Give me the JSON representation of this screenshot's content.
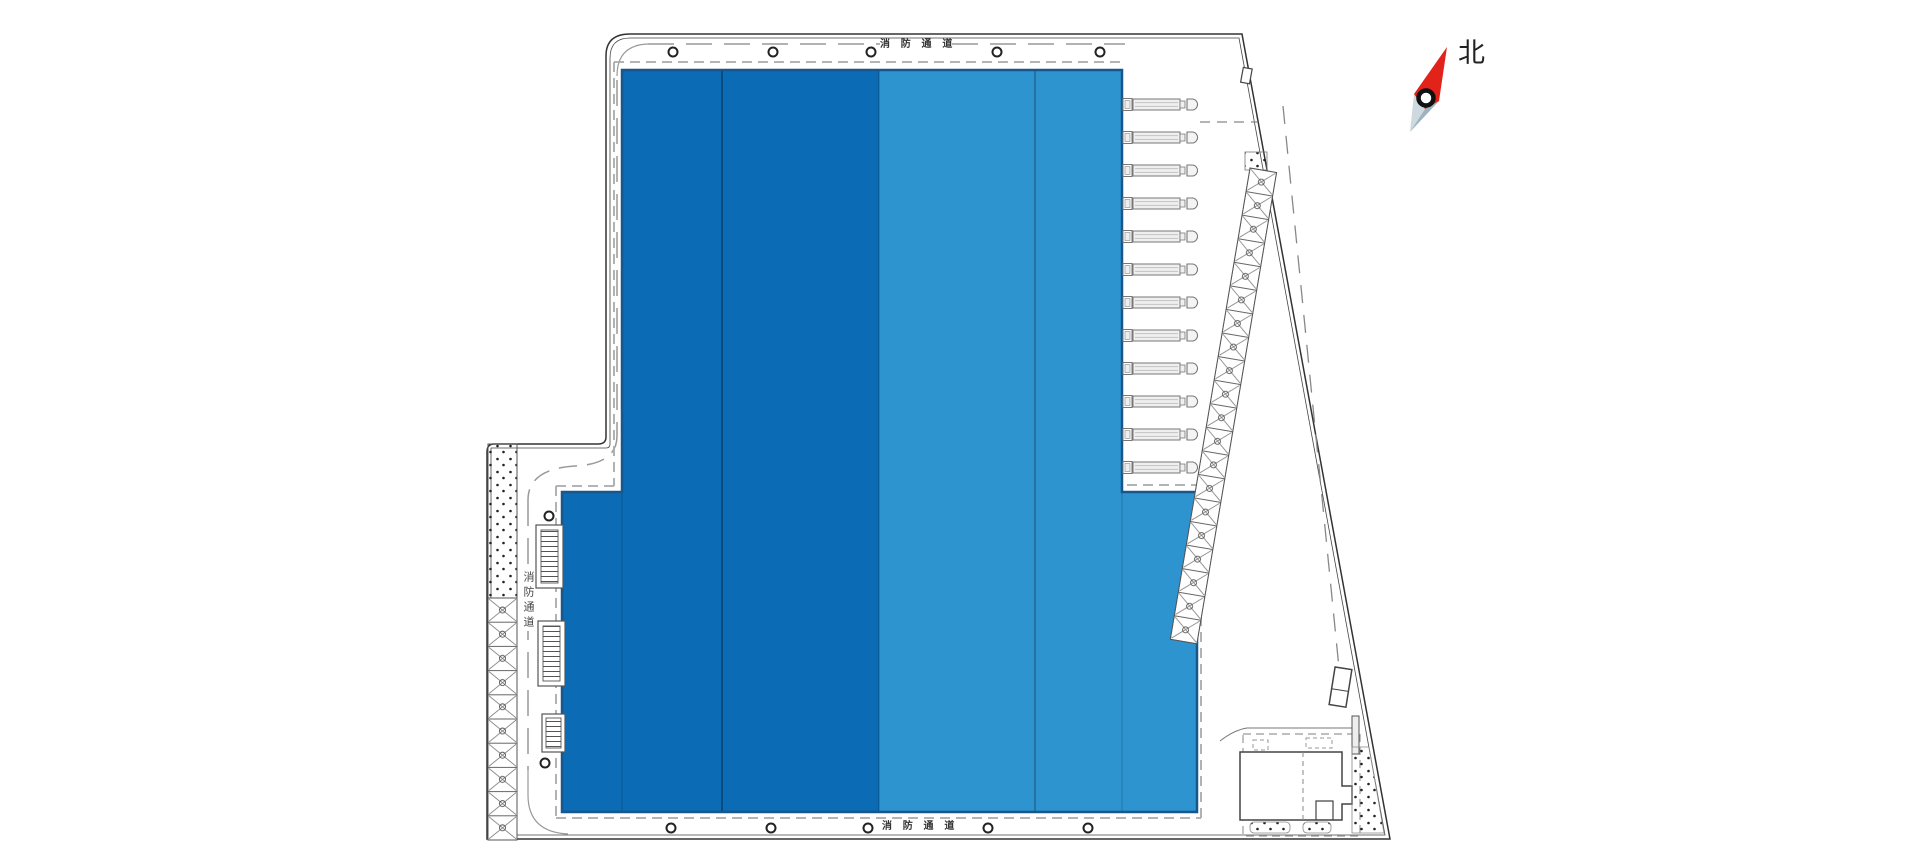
{
  "labels": {
    "fire_lane_top": "消 防 通 道",
    "fire_lane_bottom": "消 防 通 道",
    "fire_lane_left": "消防通道",
    "north": "北"
  },
  "colors": {
    "building_dark": "#0b6cb5",
    "building_light": "#2e94d0",
    "building_outline": "#17578b",
    "boundary_line": "#333333",
    "road_dash": "#999999",
    "north_red": "#e2231a",
    "north_tail_light": "#cdd9df",
    "north_tail_dark": "#9db3bd"
  },
  "counts": {
    "dock_trucks": 12,
    "left_parking_stalls": 10,
    "right_parking_stalls": 20,
    "building_bays": 4
  }
}
